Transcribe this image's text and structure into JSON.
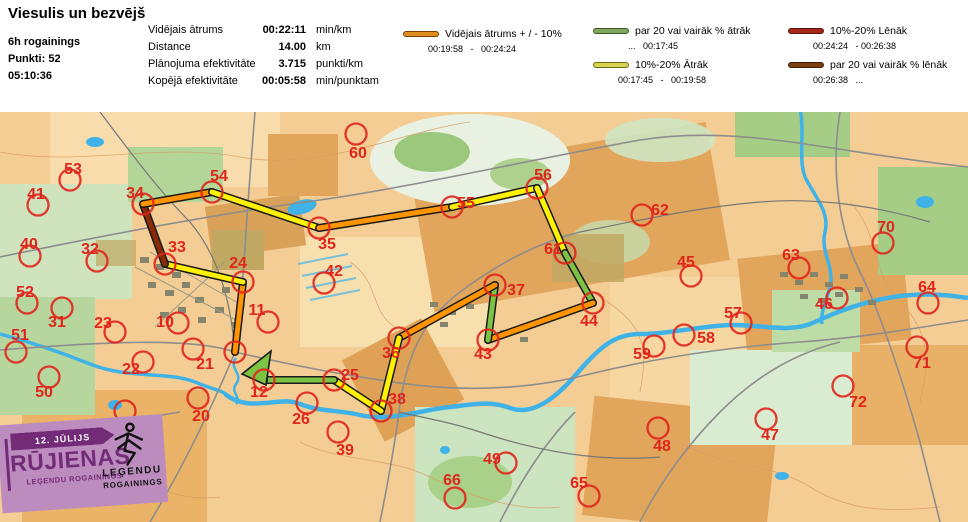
{
  "header": {
    "title": "Viesulis un bezvējš",
    "team": {
      "category": "6h rogainings",
      "points": "Punkti: 52",
      "time": "05:10:36"
    },
    "stats": [
      {
        "label": "Vidējais ātrums",
        "value": "00:22:11",
        "unit": "min/km"
      },
      {
        "label": "Distance",
        "value": "14.00",
        "unit": "km"
      },
      {
        "label": "Plānojuma efektivitāte",
        "value": "3.715",
        "unit": "punkti/km"
      },
      {
        "label": "Kopējā efektivitāte",
        "value": "00:05:58",
        "unit": "min/punktam"
      }
    ],
    "legend": [
      {
        "label": "Vidējais ātrums + / - 10%",
        "range": "00:19:58   -   00:24:24",
        "color": "#DD8E1E",
        "border": "#7A3E00"
      },
      {
        "label": "par 20 vai vairāk % ātrāk",
        "range": "...   00:17:45",
        "color": "#7EA85C",
        "border": "#3E5A22"
      },
      {
        "label": "10%-20% Ātrāk",
        "range": "00:17:45   -   00:19:58",
        "color": "#D9D450",
        "border": "#6E6E14"
      },
      {
        "label": "10%-20% Lēnāk",
        "range": "00:24:24   - 00:26:38",
        "color": "#A8291A",
        "border": "#5C120A"
      },
      {
        "label": "par 20 vai vairāk % lēnāk",
        "range": "00:26:38   ...",
        "color": "#7C3F12",
        "border": "#3F1D05"
      }
    ]
  },
  "map": {
    "route_colors": {
      "orange": "#FF9400",
      "yellow": "#FFF100",
      "green": "#7CC243",
      "darkred": "#8A2B07"
    },
    "controls": [
      {
        "n": "53",
        "x": 70,
        "y": 68,
        "lx": 73,
        "ly": 57
      },
      {
        "n": "41",
        "x": 38,
        "y": 93,
        "lx": 36,
        "ly": 82
      },
      {
        "n": "40",
        "x": 30,
        "y": 144,
        "lx": 29,
        "ly": 132
      },
      {
        "n": "32",
        "x": 97,
        "y": 149,
        "lx": 90,
        "ly": 137
      },
      {
        "n": "52",
        "x": 27,
        "y": 191,
        "lx": 25,
        "ly": 180
      },
      {
        "n": "31",
        "x": 62,
        "y": 196,
        "lx": 57,
        "ly": 210
      },
      {
        "n": "23",
        "x": 115,
        "y": 220,
        "lx": 103,
        "ly": 211
      },
      {
        "n": "10",
        "x": 178,
        "y": 211,
        "lx": 165,
        "ly": 210
      },
      {
        "n": "51",
        "x": 16,
        "y": 240,
        "lx": 20,
        "ly": 223
      },
      {
        "n": "22",
        "x": 143,
        "y": 250,
        "lx": 131,
        "ly": 257
      },
      {
        "n": "21",
        "x": 193,
        "y": 237,
        "lx": 205,
        "ly": 252
      },
      {
        "n": "50",
        "x": 49,
        "y": 265,
        "lx": 44,
        "ly": 280
      },
      {
        "n": "20",
        "x": 198,
        "y": 286,
        "lx": 201,
        "ly": 304
      },
      {
        "n": "30",
        "x": 125,
        "y": 299,
        "lx": 119,
        "ly": 313
      },
      {
        "n": "26",
        "x": 307,
        "y": 291,
        "lx": 301,
        "ly": 307
      },
      {
        "n": "39",
        "x": 338,
        "y": 320,
        "lx": 345,
        "ly": 338
      },
      {
        "n": "42",
        "x": 324,
        "y": 171,
        "lx": 334,
        "ly": 159
      },
      {
        "n": "11",
        "x": 268,
        "y": 210,
        "lx": 257,
        "ly": 198
      },
      {
        "n": "60",
        "x": 356,
        "y": 22,
        "lx": 358,
        "ly": 41
      },
      {
        "n": "62",
        "x": 642,
        "y": 103,
        "lx": 660,
        "ly": 98
      },
      {
        "n": "45",
        "x": 691,
        "y": 164,
        "lx": 686,
        "ly": 150
      },
      {
        "n": "63",
        "x": 799,
        "y": 156,
        "lx": 791,
        "ly": 143
      },
      {
        "n": "70",
        "x": 883,
        "y": 131,
        "lx": 886,
        "ly": 115
      },
      {
        "n": "64",
        "x": 928,
        "y": 191,
        "lx": 927,
        "ly": 175
      },
      {
        "n": "46",
        "x": 837,
        "y": 186,
        "lx": 824,
        "ly": 192
      },
      {
        "n": "57",
        "x": 741,
        "y": 211,
        "lx": 733,
        "ly": 201
      },
      {
        "n": "58",
        "x": 684,
        "y": 223,
        "lx": 706,
        "ly": 226
      },
      {
        "n": "59",
        "x": 654,
        "y": 234,
        "lx": 642,
        "ly": 242
      },
      {
        "n": "71",
        "x": 917,
        "y": 235,
        "lx": 922,
        "ly": 251
      },
      {
        "n": "72",
        "x": 843,
        "y": 274,
        "lx": 858,
        "ly": 290
      },
      {
        "n": "48",
        "x": 658,
        "y": 316,
        "lx": 662,
        "ly": 334
      },
      {
        "n": "47",
        "x": 766,
        "y": 307,
        "lx": 770,
        "ly": 323
      },
      {
        "n": "66",
        "x": 455,
        "y": 386,
        "lx": 452,
        "ly": 368
      },
      {
        "n": "49",
        "x": 506,
        "y": 351,
        "lx": 492,
        "ly": 347
      },
      {
        "n": "65",
        "x": 589,
        "y": 384,
        "lx": 579,
        "ly": 371
      },
      {
        "n": "24",
        "x": 243,
        "y": 170,
        "lx": 238,
        "ly": 151
      },
      {
        "n": "33",
        "x": 165,
        "y": 152,
        "lx": 177,
        "ly": 135
      },
      {
        "n": "34",
        "x": 143,
        "y": 92,
        "lx": 135,
        "ly": 81
      },
      {
        "n": "54",
        "x": 212,
        "y": 80,
        "lx": 219,
        "ly": 64
      },
      {
        "n": "35",
        "x": 319,
        "y": 116,
        "lx": 327,
        "ly": 132
      },
      {
        "n": "55",
        "x": 452,
        "y": 95,
        "lx": 466,
        "ly": 91
      },
      {
        "n": "56",
        "x": 537,
        "y": 76,
        "lx": 543,
        "ly": 63
      },
      {
        "n": "61",
        "x": 565,
        "y": 141,
        "lx": 553,
        "ly": 137
      },
      {
        "n": "44",
        "x": 593,
        "y": 191,
        "lx": 589,
        "ly": 209
      },
      {
        "n": "43",
        "x": 488,
        "y": 228,
        "lx": 483,
        "ly": 242
      },
      {
        "n": "37",
        "x": 495,
        "y": 173,
        "lx": 516,
        "ly": 178
      },
      {
        "n": "36",
        "x": 399,
        "y": 226,
        "lx": 391,
        "ly": 241
      },
      {
        "n": "38",
        "x": 381,
        "y": 299,
        "lx": 397,
        "ly": 287
      },
      {
        "n": "25",
        "x": 334,
        "y": 268,
        "lx": 350,
        "ly": 263
      },
      {
        "n": "12",
        "x": 264,
        "y": 268,
        "lx": 259,
        "ly": 280
      }
    ],
    "route": {
      "start": [
        235,
        240
      ],
      "finish_point": [
        257,
        258
      ],
      "arrow": "242,262 271,239 266,273",
      "legs": [
        [
          "start",
          "24",
          "orange"
        ],
        [
          "24",
          "33",
          "yellow"
        ],
        [
          "33",
          "34",
          "darkred"
        ],
        [
          "34",
          "54",
          "orange"
        ],
        [
          "54",
          "35",
          "yellow"
        ],
        [
          "35",
          "55",
          "orange"
        ],
        [
          "55",
          "56",
          "yellow"
        ],
        [
          "56",
          "61",
          "yellow"
        ],
        [
          "61",
          "44",
          "green"
        ],
        [
          "44",
          "43",
          "orange"
        ],
        [
          "43",
          "37",
          "green"
        ],
        [
          "37",
          "36",
          "orange"
        ],
        [
          "36",
          "38",
          "yellow"
        ],
        [
          "38",
          "25",
          "yellow"
        ],
        [
          "25",
          "12",
          "green"
        ],
        [
          "12",
          "finish_end",
          "green"
        ]
      ]
    },
    "banner": {
      "date": "12. JŪLIJS",
      "title": "RŪJIENAS",
      "subtitle": "LEĢENDU ROGAININGS",
      "logo_top": "LEĢENDU",
      "logo_bottom": "ROGAININGS",
      "bg": "#BD8CBE",
      "accent": "#732B77"
    }
  }
}
